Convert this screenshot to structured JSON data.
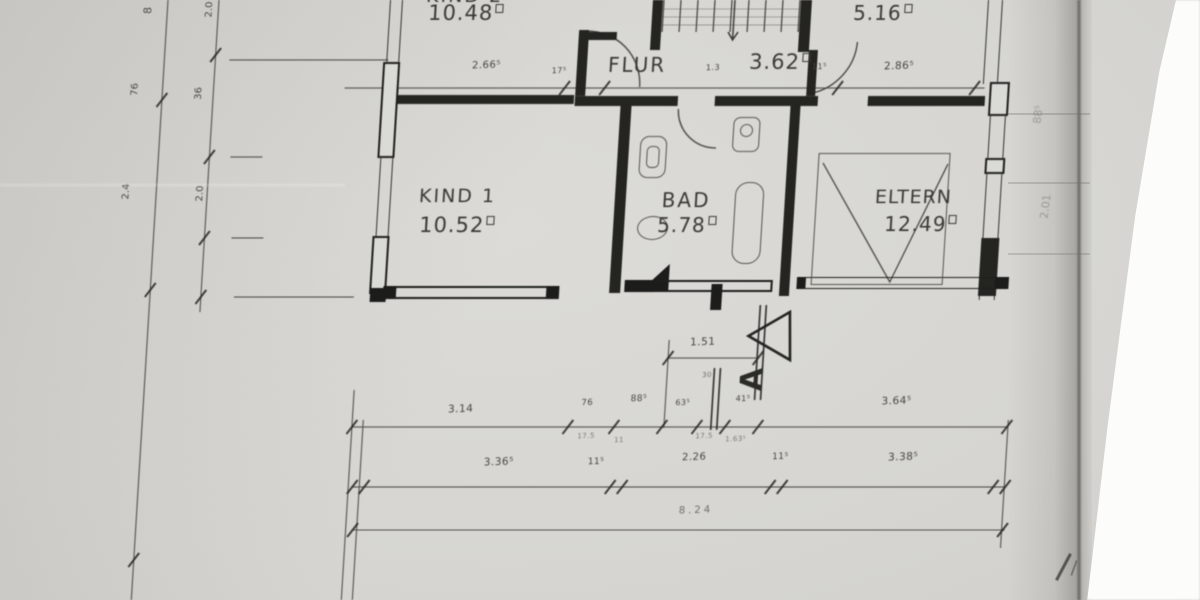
{
  "rooms": {
    "kind2": {
      "name": "KIND 2",
      "area": "10.48"
    },
    "flur": {
      "name": "FLUR",
      "area": "3.62"
    },
    "store": {
      "area": "5.16"
    },
    "kind1": {
      "name": "KIND 1",
      "area": "10.52"
    },
    "bad": {
      "name": "BAD",
      "area": "5.78"
    },
    "eltern": {
      "name": "ELTERN",
      "area": "12.49"
    }
  },
  "section": {
    "letter": "A"
  },
  "dims": {
    "interior": [
      "2.66⁵",
      "17⁵",
      "1.3",
      "11⁵",
      "2.86⁵"
    ],
    "chain151": {
      "value": "1.51",
      "sub": "30"
    },
    "row1": [
      "3.14",
      "76",
      "88⁵",
      "63⁵",
      "41⁵",
      "3.64⁵"
    ],
    "row1_sub": [
      "17.5",
      "11",
      "17.5",
      "1.63⁵"
    ],
    "row2": [
      "3.36⁵",
      "11⁵",
      "2.26",
      "11⁵",
      "3.38⁵"
    ],
    "total": "8.24",
    "left_outer": [
      "8",
      "76",
      "2.4"
    ],
    "left_inner": [
      "2.0",
      "36",
      "2.0"
    ],
    "right_faint": [
      "88⁵",
      "2.01"
    ]
  }
}
